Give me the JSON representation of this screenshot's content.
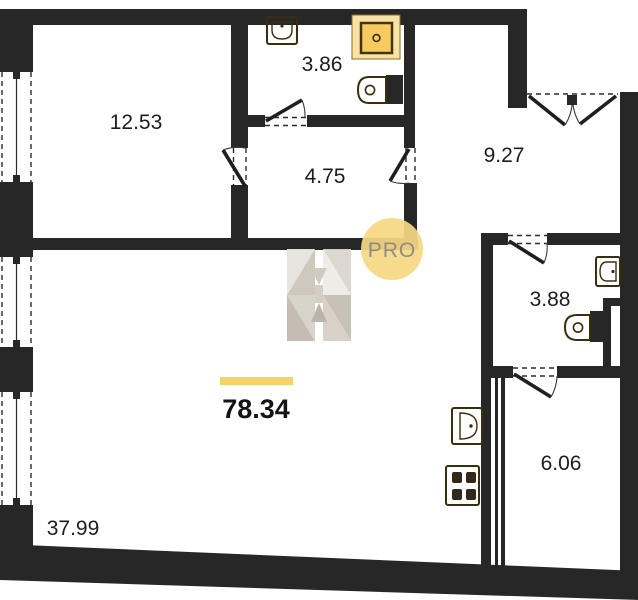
{
  "plan": {
    "badge": "PRO",
    "total": {
      "area": "78.34"
    },
    "rooms": [
      {
        "id": "living-room",
        "area": "12.53"
      },
      {
        "id": "bathroom",
        "area": "3.86"
      },
      {
        "id": "hallway",
        "area": "4.75"
      },
      {
        "id": "entrance-hall",
        "area": "9.27"
      },
      {
        "id": "wc",
        "area": "3.88"
      },
      {
        "id": "pantry",
        "area": "6.06"
      },
      {
        "id": "kitchen-living-room",
        "area": "37.99"
      }
    ],
    "colors": {
      "wall": "#272727",
      "fixture": "#f6cf67",
      "accent": "#f2d469",
      "badge": "#f6d883"
    }
  }
}
